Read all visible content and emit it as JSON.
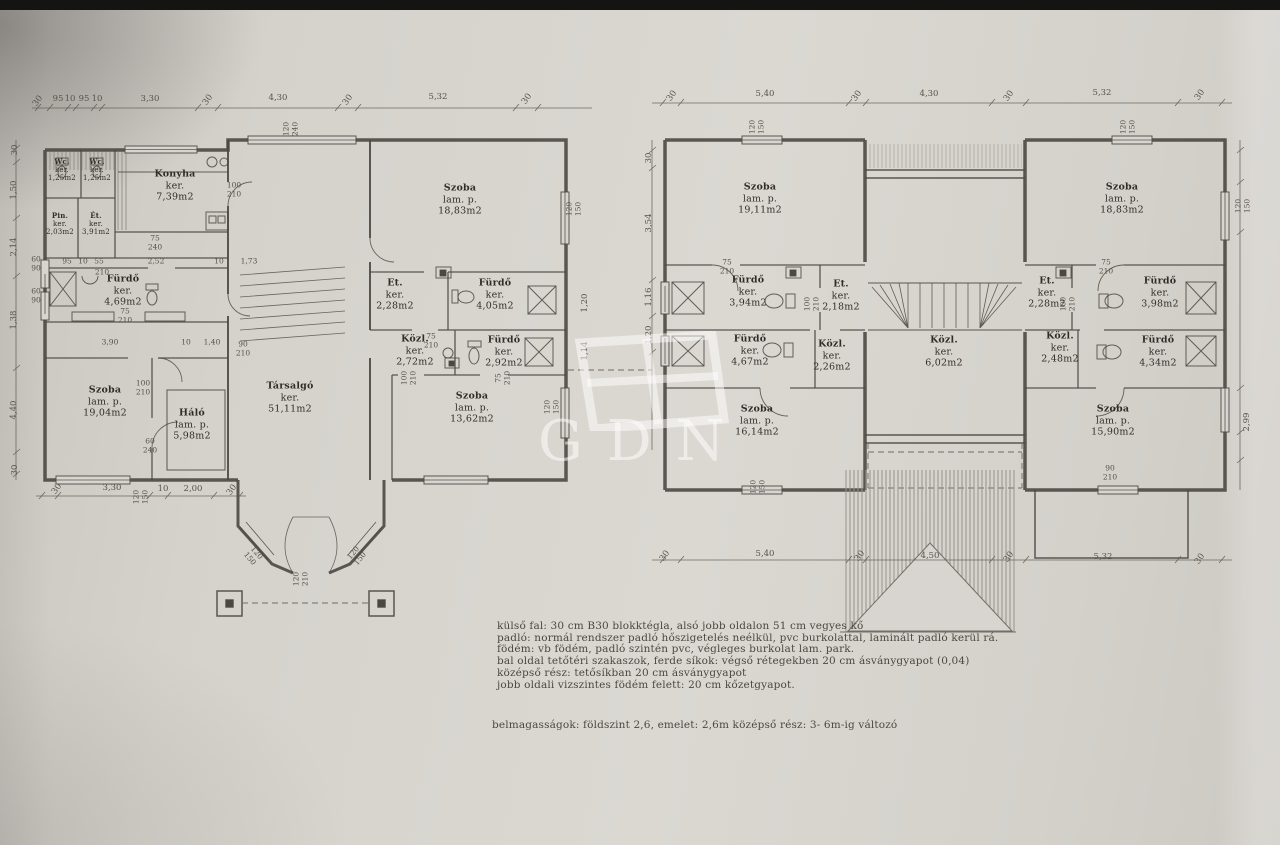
{
  "colors": {
    "paper": "#d8d5d0",
    "wall_line": "#4b4843",
    "dim_line": "#5a5751",
    "text": "#2f2d29",
    "top_bar": "#141412",
    "watermark": "rgba(255,255,255,0.52)"
  },
  "watermark": {
    "text": "GDN"
  },
  "ground_floor": {
    "rooms": [
      {
        "name": "Wc.",
        "finish": "ker.",
        "area": "1,25m2"
      },
      {
        "name": "Wc.",
        "finish": "ker.",
        "area": "1,25m2"
      },
      {
        "name": "Konyha",
        "finish": "ker.",
        "area": "7,39m2"
      },
      {
        "name": "Pin.",
        "finish": "ker.",
        "area": "2,03m2"
      },
      {
        "name": "Ét.",
        "finish": "ker.",
        "area": "3,91m2"
      },
      {
        "name": "Fürdő",
        "finish": "ker.",
        "area": "4,69m2"
      },
      {
        "name": "Szoba",
        "finish": "lam. p.",
        "area": "19,04m2"
      },
      {
        "name": "Háló",
        "finish": "lam. p.",
        "area": "5,98m2"
      },
      {
        "name": "Társalgó",
        "finish": "ker.",
        "area": "51,11m2"
      },
      {
        "name": "Et.",
        "finish": "ker.",
        "area": "2,28m2"
      },
      {
        "name": "Fürdő",
        "finish": "ker.",
        "area": "4,05m2"
      },
      {
        "name": "Közl.",
        "finish": "ker.",
        "area": "2,72m2"
      },
      {
        "name": "Fürdő",
        "finish": "ker.",
        "area": "2,92m2"
      },
      {
        "name": "Szoba",
        "finish": "lam. p.",
        "area": "18,83m2"
      },
      {
        "name": "Szoba",
        "finish": "lam. p.",
        "area": "13,62m2"
      }
    ],
    "dims_top": [
      "30",
      "95",
      "10",
      "95",
      "10",
      "3,30",
      "30",
      "4,30",
      "30",
      "5,32",
      "30"
    ],
    "dims_bottom": [
      "30",
      "3,30",
      "10",
      "2,00",
      "30"
    ],
    "dims_left": [
      "30",
      "1,50",
      "2,14",
      "1,38",
      "4,40",
      "30"
    ],
    "dims_right": [
      "1,20",
      "1,14"
    ],
    "dims_inner_a": [
      "95",
      "10",
      "55",
      "2,52",
      "10",
      "1,73",
      "210"
    ],
    "dims_inner_b": [
      "3,90",
      "10",
      "1,40"
    ],
    "tags": [
      "100\n210",
      "75\n210",
      "90\n210",
      "100\n210",
      "60\n240",
      "100\n210",
      "75\n210",
      "75\n210",
      "120\n210",
      "120\n150",
      "120\n150",
      "120\n240",
      "120\n150",
      "120\n150",
      "60\n90",
      "60\n90",
      "120\n150",
      "75\n240"
    ]
  },
  "upper_floor": {
    "rooms": [
      {
        "name": "Szoba",
        "finish": "lam. p.",
        "area": "19,11m2"
      },
      {
        "name": "Fürdő",
        "finish": "ker.",
        "area": "3,94m2"
      },
      {
        "name": "Et.",
        "finish": "ker.",
        "area": "2,18m2"
      },
      {
        "name": "Fürdő",
        "finish": "ker.",
        "area": "4,67m2"
      },
      {
        "name": "Közl.",
        "finish": "ker.",
        "area": "2,26m2"
      },
      {
        "name": "Szoba",
        "finish": "lam. p.",
        "area": "16,14m2"
      },
      {
        "name": "Közl.",
        "finish": "ker.",
        "area": "6,02m2"
      },
      {
        "name": "Szoba",
        "finish": "lam. p.",
        "area": "18,83m2"
      },
      {
        "name": "Et.",
        "finish": "ker.",
        "area": "2,28m2"
      },
      {
        "name": "Fürdő",
        "finish": "ker.",
        "area": "3,98m2"
      },
      {
        "name": "Közl.",
        "finish": "ker.",
        "area": "2,48m2"
      },
      {
        "name": "Fürdő",
        "finish": "ker.",
        "area": "4,34m2"
      },
      {
        "name": "Szoba",
        "finish": "lam. p.",
        "area": "15,90m2"
      }
    ],
    "dims_top": [
      "30",
      "5,40",
      "30",
      "4,30",
      "30",
      "5,32",
      "30"
    ],
    "dims_bottom": [
      "30",
      "5,40",
      "30",
      "4,50",
      "30",
      "5,32",
      "30"
    ],
    "dims_left": [
      "30",
      "3,54",
      "1,16",
      "1,20"
    ],
    "dims_right": [
      "2,99"
    ],
    "tags": [
      "75\n210",
      "100\n210",
      "100\n210",
      "75\n210",
      "90\n210",
      "120\n150",
      "120\n150",
      "120\n150",
      "120\n150"
    ]
  },
  "notes": {
    "lines": [
      "külső fal: 30 cm B30 blokktégla, alsó jobb oldalon 51 cm vegyes kő",
      "padló: normál rendszer padló hőszigetelés neélkül, pvc burkolattal, laminált padló kerül rá.",
      "födém: vb födém, padló szintén pvc, végleges burkolat lam. park.",
      "bal oldal tetőtéri szakaszok, ferde síkok: végső rétegekben 20 cm ásványgyapot (0,04)",
      "középső rész: tetősíkban 20 cm ásványgyapot",
      "jobb oldali vizszintes födém felett: 20 cm kőzetgyapot."
    ],
    "heights": "belmagasságok: földszint 2,6,  emelet: 2,6m középső rész: 3- 6m-ig változó"
  }
}
